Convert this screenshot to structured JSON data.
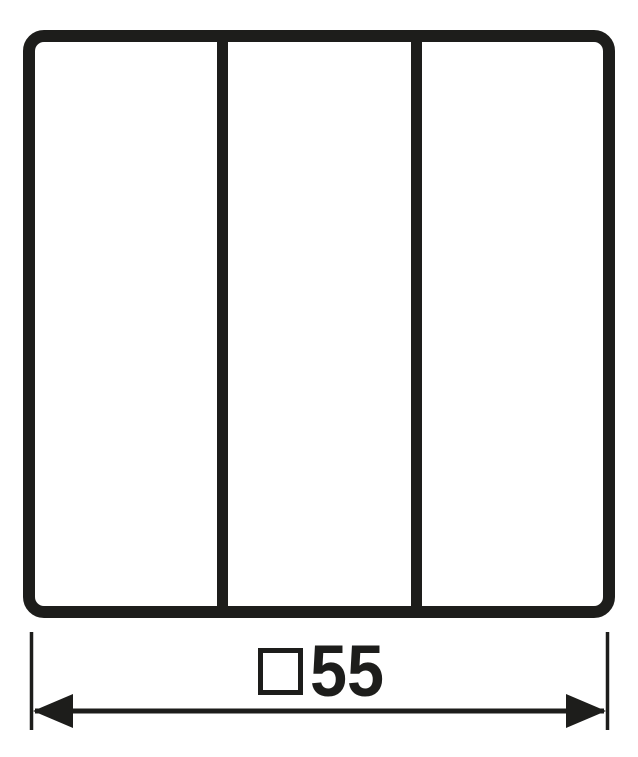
{
  "page": {
    "background": "#ffffff"
  },
  "diagram": {
    "subject": "3-gang rocker switch plate, front view with width dimension",
    "line_color": "#1d1d1b",
    "plate": {
      "rocker_count": 3
    },
    "dimension": {
      "symbol": "□",
      "value": "55",
      "full_label": "□55"
    }
  }
}
